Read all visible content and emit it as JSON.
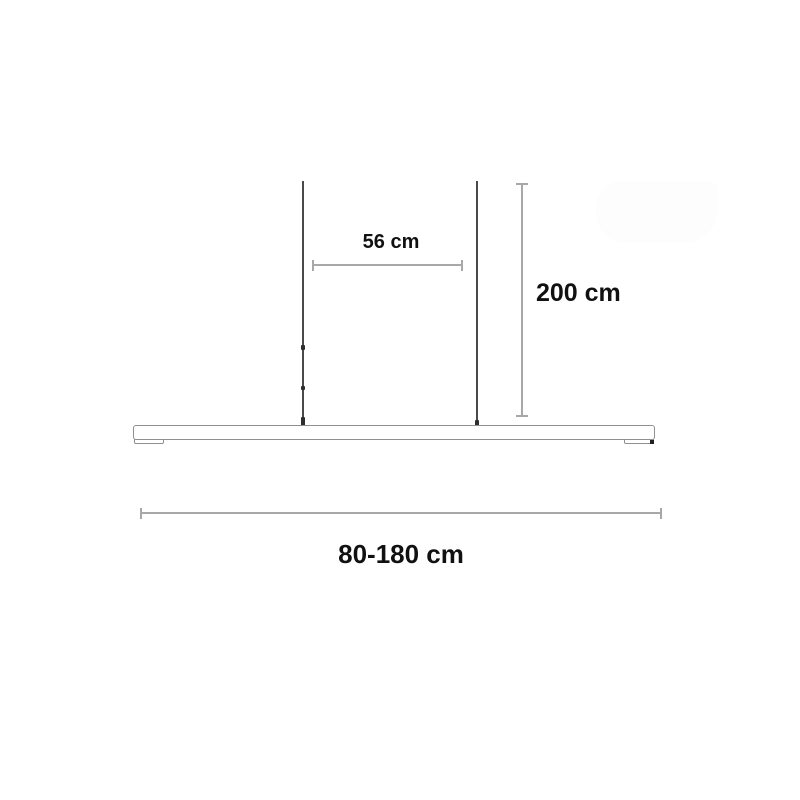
{
  "diagram": {
    "subject": "linear-pendant-lamp-dimensions",
    "dimensions": {
      "wire_spacing": {
        "label": "56 cm"
      },
      "suspension_height": {
        "label": "200 cm"
      },
      "bar_width_range": {
        "label": "80-180 cm"
      }
    },
    "colors": {
      "background": "#ffffff",
      "wire": "#4a4a4a",
      "dimension_line": "#a8a8a8",
      "fixture_outline": "#8f8f8f",
      "label_text": "#111111"
    }
  }
}
